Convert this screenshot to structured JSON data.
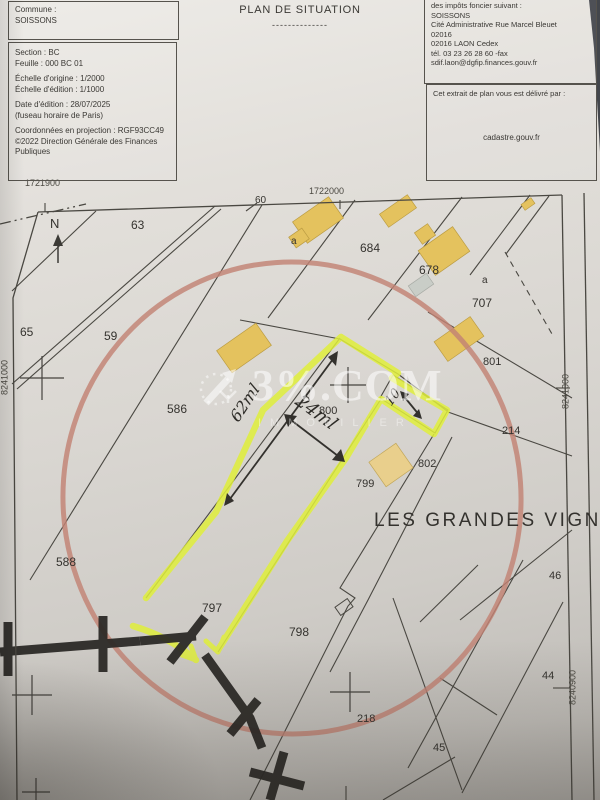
{
  "header": {
    "commune": {
      "label": "Commune :",
      "value": "SOISSONS"
    },
    "details_lines": [
      "Section : BC",
      "Feuille : 000 BC 01",
      "",
      "Échelle d'origine : 1/2000",
      "Échelle d'édition : 1/1000",
      "",
      "Date d'édition : 28/07/2025",
      "(fuseau horaire de Paris)",
      "",
      "Coordonnées en projection : RGF93CC49",
      "©2022 Direction Générale des Finances",
      "Publiques"
    ],
    "title": "PLAN DE SITUATION",
    "title_underline": "--------------",
    "office": {
      "clipped_line": "des impôts foncier suivant :",
      "lines": [
        "SOISSONS",
        "Cité Administrative Rue Marcel Bleuet",
        "02016",
        "02016 LAON Cedex",
        "tél. 03 23 26 28 60 -fax",
        "sdif.laon@dgfip.finances.gouv.fr"
      ]
    },
    "issued": {
      "label": "Cet extrait de plan vous est délivré par :",
      "site": "cadastre.gouv.fr"
    }
  },
  "map": {
    "labels": [
      {
        "t": "1721900",
        "x": 25,
        "y": 179,
        "s": 9,
        "cls": "coord",
        "name": "grid-coord-1721900"
      },
      {
        "t": "1722000",
        "x": 309,
        "y": 187,
        "s": 9,
        "cls": "coord",
        "name": "grid-coord-1722000"
      },
      {
        "t": "8241000",
        "x": -17,
        "y": 373,
        "s": 9,
        "rot": -90,
        "w": 44,
        "cls": "coord",
        "name": "grid-coord-8241000-left"
      },
      {
        "t": "8241000",
        "x": 544,
        "y": 387,
        "s": 9,
        "rot": -90,
        "w": 44,
        "cls": "coord",
        "name": "grid-coord-8241000-right"
      },
      {
        "t": "8240900",
        "x": 551,
        "y": 683,
        "s": 9,
        "rot": -90,
        "w": 44,
        "cls": "coord",
        "name": "grid-coord-8240900"
      },
      {
        "t": "N",
        "x": 50,
        "y": 217,
        "s": 13,
        "name": "north-label"
      },
      {
        "t": "63",
        "x": 131,
        "y": 219,
        "s": 12,
        "cls": "pnum",
        "name": "parcel-63"
      },
      {
        "t": "60",
        "x": 255,
        "y": 196,
        "s": 10,
        "cls": "pnum",
        "name": "parcel-60"
      },
      {
        "t": "a",
        "x": 291,
        "y": 237,
        "s": 10,
        "cls": "pnum",
        "name": "parcel-a-1"
      },
      {
        "t": "684",
        "x": 360,
        "y": 242,
        "s": 12,
        "cls": "pnum",
        "name": "parcel-684"
      },
      {
        "t": "678",
        "x": 419,
        "y": 264,
        "s": 12,
        "cls": "pnum",
        "name": "parcel-678"
      },
      {
        "t": "a",
        "x": 482,
        "y": 276,
        "s": 10,
        "cls": "pnum",
        "name": "parcel-a-2"
      },
      {
        "t": "707",
        "x": 472,
        "y": 297,
        "s": 12,
        "cls": "pnum",
        "name": "parcel-707"
      },
      {
        "t": "65",
        "x": 20,
        "y": 326,
        "s": 12,
        "cls": "pnum",
        "name": "parcel-65"
      },
      {
        "t": "59",
        "x": 104,
        "y": 330,
        "s": 12,
        "cls": "pnum",
        "name": "parcel-59"
      },
      {
        "t": "801",
        "x": 483,
        "y": 357,
        "s": 11,
        "cls": "pnum",
        "name": "parcel-801"
      },
      {
        "t": "586",
        "x": 167,
        "y": 403,
        "s": 12,
        "cls": "pnum",
        "name": "parcel-586"
      },
      {
        "t": "800",
        "x": 319,
        "y": 406,
        "s": 11,
        "cls": "pnum",
        "name": "parcel-800"
      },
      {
        "t": "214",
        "x": 502,
        "y": 426,
        "s": 11,
        "cls": "pnum",
        "name": "parcel-214"
      },
      {
        "t": "802",
        "x": 418,
        "y": 459,
        "s": 11,
        "cls": "pnum",
        "name": "parcel-802"
      },
      {
        "t": "799",
        "x": 356,
        "y": 479,
        "s": 11,
        "cls": "pnum",
        "name": "parcel-799"
      },
      {
        "t": "588",
        "x": 56,
        "y": 556,
        "s": 12,
        "cls": "pnum",
        "name": "parcel-588"
      },
      {
        "t": "46",
        "x": 549,
        "y": 571,
        "s": 11,
        "cls": "pnum",
        "name": "parcel-46"
      },
      {
        "t": "797",
        "x": 202,
        "y": 602,
        "s": 12,
        "cls": "pnum",
        "name": "parcel-797"
      },
      {
        "t": "798",
        "x": 289,
        "y": 626,
        "s": 12,
        "cls": "pnum",
        "name": "parcel-798"
      },
      {
        "t": "44",
        "x": 542,
        "y": 671,
        "s": 11,
        "cls": "pnum",
        "name": "parcel-44"
      },
      {
        "t": "218",
        "x": 357,
        "y": 714,
        "s": 11,
        "cls": "pnum",
        "name": "parcel-218"
      },
      {
        "t": "45",
        "x": 433,
        "y": 743,
        "s": 11,
        "cls": "pnum",
        "name": "parcel-45"
      },
      {
        "t": "LES GRANDES VIGNES",
        "x": 374,
        "y": 511,
        "s": 19,
        "cls": "place",
        "name": "lieu-dit-les-grandes-vignes"
      },
      {
        "t": "62ml",
        "x": 225,
        "y": 395,
        "s": 16,
        "rot": -57,
        "cls": "hand",
        "name": "handwritten-measure-62ml"
      },
      {
        "t": "24ml",
        "x": 293,
        "y": 404,
        "s": 18,
        "rot": 36,
        "cls": "hand",
        "name": "handwritten-measure-24ml"
      },
      {
        "t": "10",
        "x": 385,
        "y": 391,
        "s": 13,
        "rot": -55,
        "cls": "hand",
        "name": "handwritten-measure-10"
      }
    ]
  },
  "watermark": {
    "brand": "3%.COM",
    "sub": "IMMOBILIER"
  },
  "colors": {
    "highlighter": "#e0ef3b",
    "circle_marker": "#c28274",
    "building_fill": "#e4c25e",
    "building_light": "#e9cf8c",
    "line_ink": "#4a4842",
    "pen_ink": "#33312d",
    "marker_black": "#2b2926",
    "photo_background": "#43464c"
  }
}
